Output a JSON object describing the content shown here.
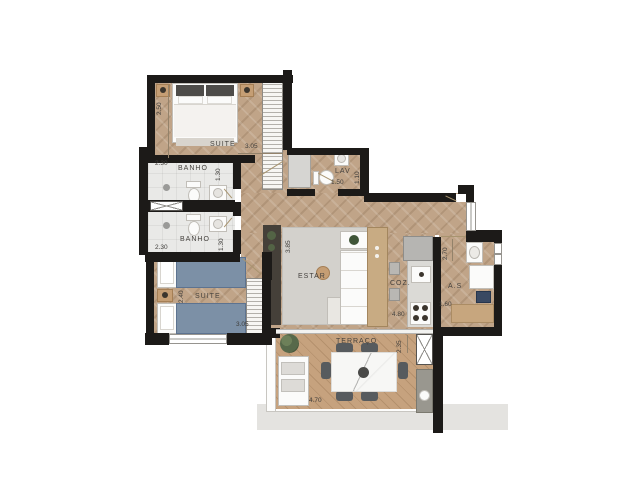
{
  "rooms": {
    "suite1": {
      "label": "SUITE",
      "width": "2.50",
      "length": "3.05"
    },
    "banho1": {
      "label": "BANHO",
      "width": "2.30",
      "length": "1.30"
    },
    "banho2": {
      "label": "BANHO",
      "width": "2.30",
      "length": "1.30"
    },
    "suite2": {
      "label": "SUITE",
      "width": "2.40",
      "length": "3.05"
    },
    "lav": {
      "label": "LAV",
      "width": "1.50",
      "length": "1.10"
    },
    "estar": {
      "label": "ESTAR",
      "height": "3.85"
    },
    "coz": {
      "label": "COZ.",
      "length": "4.80"
    },
    "as": {
      "label": "A.S",
      "height": "2.70",
      "width": "1.60"
    },
    "terraco": {
      "label": "TERRAÇO",
      "height": "2.35",
      "width": "4.70"
    }
  },
  "colors": {
    "wall": "#1c1a18",
    "wood_floor": "#c0a488",
    "terrace_wood": "#c6a27e",
    "bathroom_tile": "#e9e9e7",
    "bed_blue": "#7c90a6",
    "rug_gray": "#d3d1cc"
  }
}
